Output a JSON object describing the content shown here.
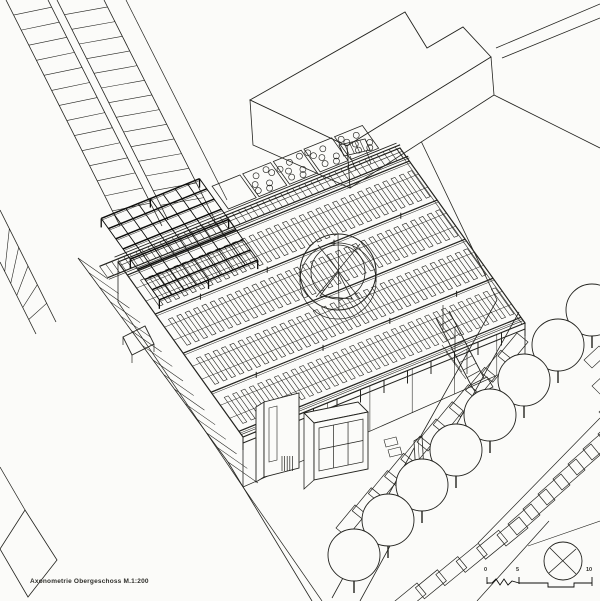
{
  "canvas": {
    "width": 600,
    "height": 601
  },
  "colors": {
    "paper": "#fbfbf9",
    "ink": "#23231f",
    "ink_dark": "#0d0d0b",
    "ink_light": "#52524c"
  },
  "caption": {
    "text": "Axonometrie Obergeschoss  M.1:200"
  },
  "scale_bar": {
    "labels": [
      "0",
      "5",
      "10"
    ]
  }
}
